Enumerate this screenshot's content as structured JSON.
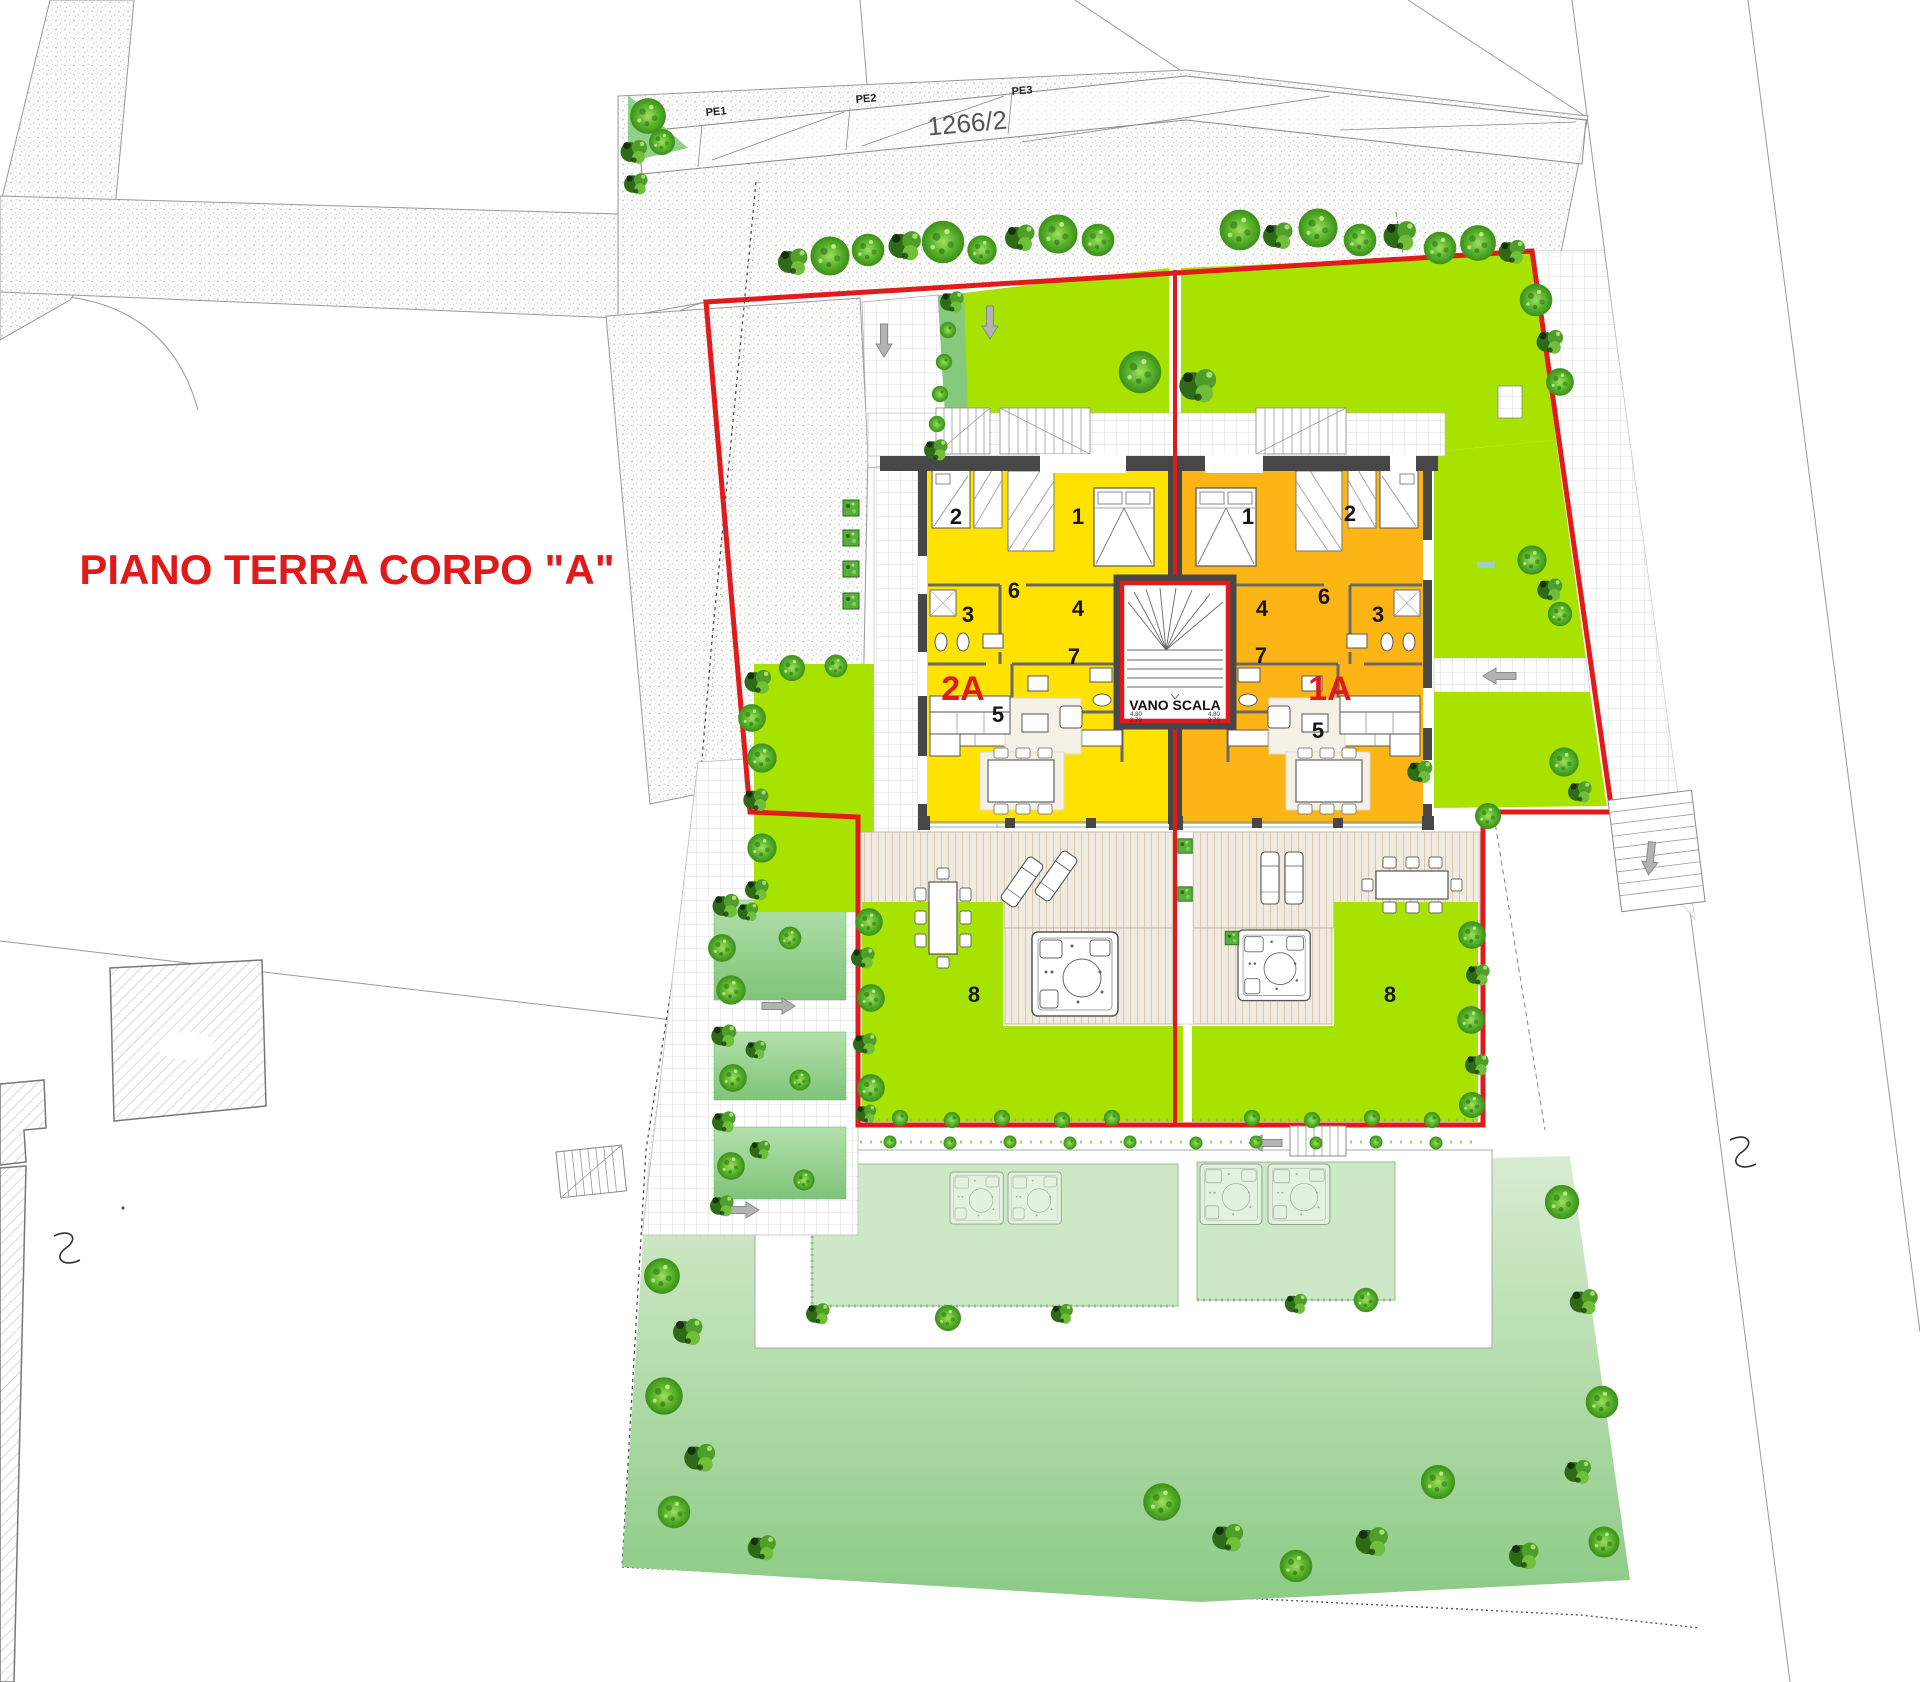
{
  "drawing": {
    "title": "PIANO TERRA CORPO \"A\"",
    "parcel_number": "1266/2",
    "pe_labels": [
      "PE1",
      "PE2",
      "PE3"
    ],
    "stairwell": {
      "label": "VANO SCALA",
      "dim_left_top": "4.80",
      "dim_left_bottom": "2.70",
      "dim_right_top": "4.80",
      "dim_right_bottom": "2.70"
    },
    "units": [
      {
        "code": "2A",
        "rooms": [
          "1",
          "2",
          "3",
          "4",
          "5",
          "6",
          "7"
        ],
        "garden_label": "8"
      },
      {
        "code": "1A",
        "rooms": [
          "1",
          "2",
          "3",
          "4",
          "5",
          "6",
          "7"
        ],
        "garden_label": "8"
      }
    ],
    "colors": {
      "unit_2a_fill": "#FFE200",
      "unit_1a_fill": "#FDB515",
      "garden_bright": "#A8E300",
      "lawn_light": "#D9EDD1",
      "lawn_dark": "#8CCB86",
      "boundary_red": "#E11B1B",
      "wall_dark": "#474747",
      "label_red": "#E01A1A"
    },
    "icons": {
      "direction_arrow": "block-arrow",
      "section_marker": "s-curve",
      "tree": "landscape-tree",
      "jacuzzi": "hot-tub",
      "stairs": "tread-lines"
    }
  }
}
